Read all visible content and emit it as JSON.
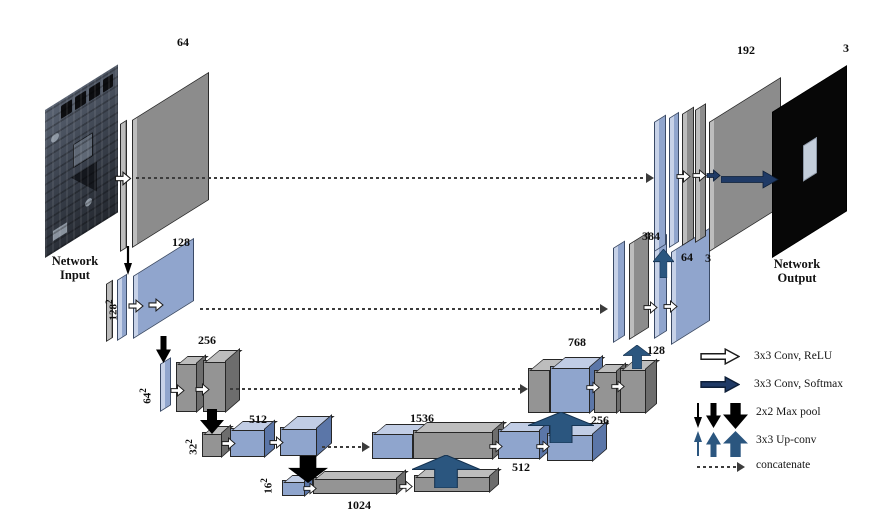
{
  "diagram_title": "U-Net segmentation network",
  "input": {
    "caption1": "Network",
    "caption2": "Input"
  },
  "output": {
    "caption1": "Network",
    "caption2": "Output",
    "channels": "3"
  },
  "labels": {
    "enc1_ch": "64",
    "enc2_ch": "128",
    "enc2_size": "128",
    "enc2_exp": "2",
    "enc3_ch": "256",
    "enc3_size": "64",
    "enc3_exp": "2",
    "enc4_ch": "512",
    "enc4_size": "32",
    "enc4_exp": "2",
    "enc5_ch": "1024",
    "enc5_size": "16",
    "enc5_exp": "2",
    "dec4_concat": "1536",
    "dec4_conv": "512",
    "dec4_up": "256",
    "dec3_concat": "768",
    "dec3_up": "128",
    "dec2_concat": "384",
    "dec2_up": "64",
    "dec1_concat": "192",
    "dec1_out": "3"
  },
  "legend": {
    "items": [
      {
        "icon": "conv-relu-arrow-icon",
        "label": "3x3 Conv, ReLU"
      },
      {
        "icon": "conv-softmax-arrow-icon",
        "label": "3x3 Conv, Softmax"
      },
      {
        "icon": "maxpool-arrows-icon",
        "label": "2x2 Max pool"
      },
      {
        "icon": "upconv-arrows-icon",
        "label": "3x3 Up-conv"
      },
      {
        "icon": "concat-arrow-icon",
        "label": "concatenate"
      }
    ]
  },
  "colors": {
    "layer_gray": "#8c8c8c",
    "layer_blue": "#90a5cd",
    "arrow_navy": "#1f3a66",
    "arrow_steel": "#2b567f",
    "arrow_black": "#000000",
    "output_bg": "#070707"
  }
}
